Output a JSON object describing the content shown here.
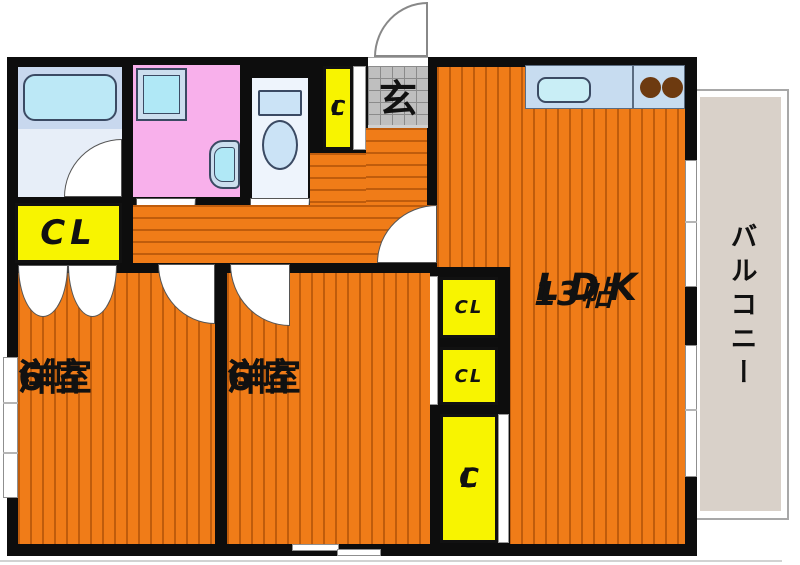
{
  "plan": {
    "entrance_label": "玄",
    "balcony_label": "バルコニー",
    "ldk": {
      "name": "LDK",
      "size": "13帖"
    },
    "bedroom1": {
      "name": "洋室",
      "size": "6帖"
    },
    "bedroom2": {
      "name": "洋室",
      "size": "6帖"
    },
    "closet_label": "CL",
    "closet_letter_c": "C",
    "closet_letter_l": "L"
  },
  "colors": {
    "floor_orange": "#f07c18",
    "floor_stripe": "#bf5c0c",
    "closet_yellow": "#f8f400",
    "washroom_pink": "#f8b0eb",
    "bath_blue": "#c8d8ee",
    "fixture_cyan": "#b0e8f6",
    "entrance_tile_gray": "#bfbfbf",
    "balcony_beige": "#d9d1c9",
    "wall_black": "#0d0d0d",
    "burner_brown": "#6d3a10"
  }
}
